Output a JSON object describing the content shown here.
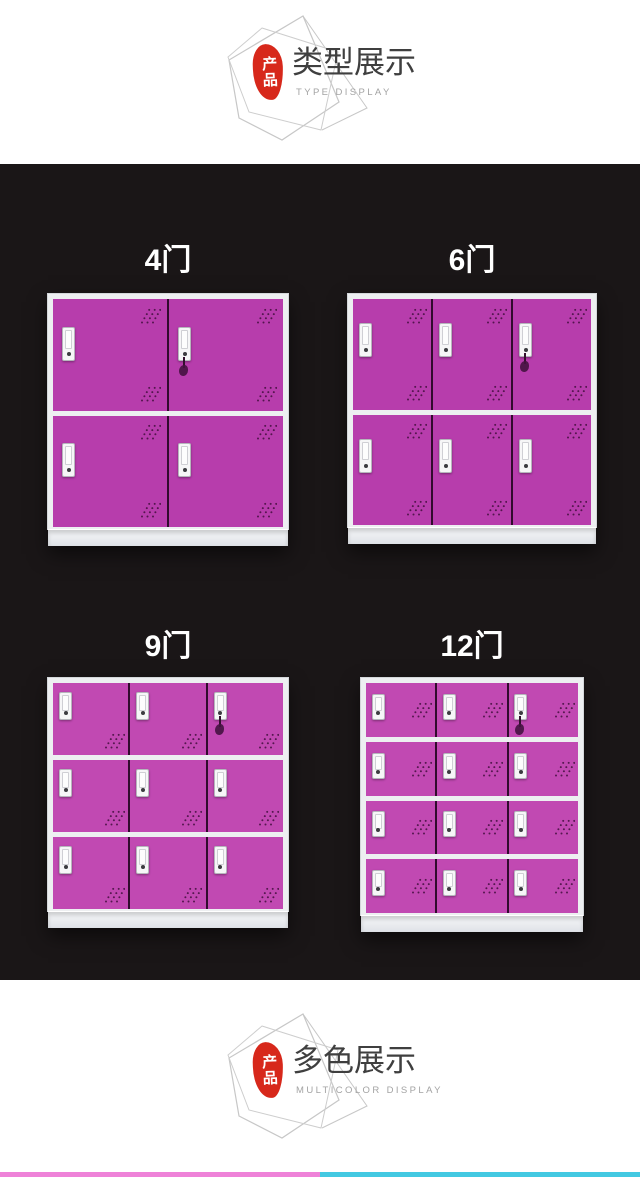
{
  "header_badge": {
    "seal_text": "产品",
    "title": "类型展示",
    "subtitle": "TYPE DISPLAY"
  },
  "footer_badge": {
    "seal_text": "产品",
    "title": "多色展示",
    "subtitle": "MULTICOLOR DISPLAY"
  },
  "showcase": {
    "background": "#1a1617",
    "door_color": "#b73dac",
    "door_color_alt": "#c149b2",
    "lockers": [
      {
        "label": "4门",
        "doors": 4,
        "rows": 2,
        "cols": 2,
        "vents": "double"
      },
      {
        "label": "6门",
        "doors": 6,
        "rows": 2,
        "cols": 3,
        "vents": "double"
      },
      {
        "label": "9门",
        "doors": 9,
        "rows": 3,
        "cols": 3,
        "vents": "bottom"
      },
      {
        "label": "12门",
        "doors": 12,
        "rows": 4,
        "cols": 3,
        "vents": "middle"
      }
    ]
  },
  "colors": {
    "seal_red": "#d7281b",
    "strip_left_pink": "#ee82d8",
    "strip_right_cyan": "#43c9e2"
  }
}
